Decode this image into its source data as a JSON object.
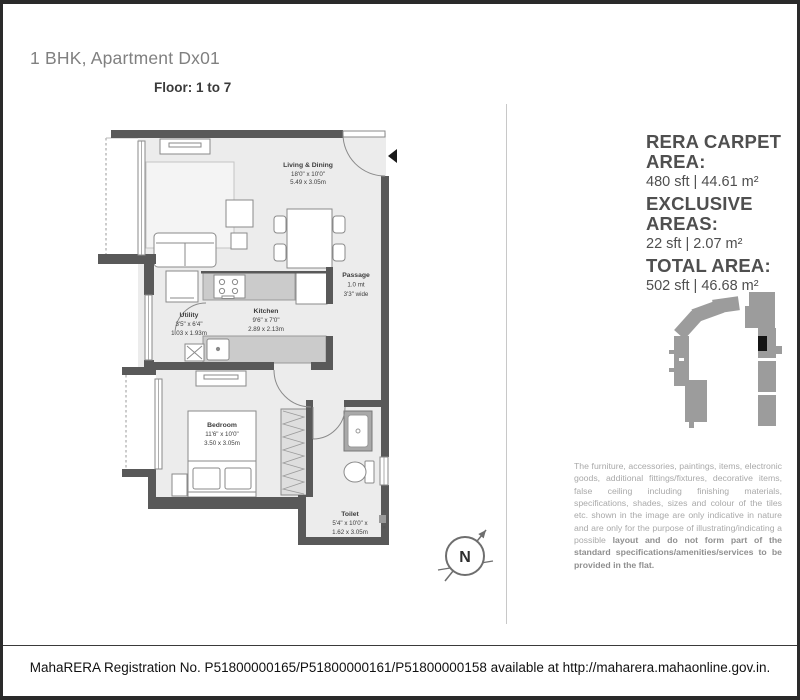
{
  "header": {
    "title": "1 BHK, Apartment Dx01",
    "floor_label": "Floor: 1 to 7"
  },
  "area_panel": {
    "items": [
      {
        "label": "RERA CARPET AREA:",
        "value": "480 sft | 44.61 m²"
      },
      {
        "label": "EXCLUSIVE AREAS:",
        "value": "22 sft | 2.07 m²"
      },
      {
        "label": "TOTAL AREA:",
        "value": "502 sft | 46.68 m²"
      }
    ]
  },
  "floor_plan": {
    "rooms": {
      "living": {
        "name": "Living & Dining",
        "dim_ft": "18'0\" x 10'0\"",
        "dim_m": "5.49 x 3.05m"
      },
      "passage": {
        "name": "Passage",
        "dim_ft": "1.0 mt",
        "dim_m": "3'3\" wide"
      },
      "kitchen": {
        "name": "Kitchen",
        "dim_ft": "9'6\" x 7'0\"",
        "dim_m": "2.89 x 2.13m"
      },
      "utility": {
        "name": "Utility",
        "dim_ft": "3'5\" x 6'4\"",
        "dim_m": "1.03 x 1.93m"
      },
      "bedroom": {
        "name": "Bedroom",
        "dim_ft": "11'6\" x 10'0\"",
        "dim_m": "3.50 x 3.05m"
      },
      "toilet": {
        "name": "Toilet",
        "dim_ft": "5'4\" x 10'0\" x",
        "dim_m": "1.62 x 3.05m"
      }
    }
  },
  "compass": {
    "label": "N"
  },
  "disclaimer": {
    "normal": "The furniture, accessories, paintings, items, electronic goods, additional fittings/fixtures, decorative items, false ceiling including finishing materials, specifications, shades, sizes and colour of the tiles etc. shown in the image are only indicative in nature and are only for the purpose of illustrating/indicating a possible ",
    "bold": "layout and do not form part of the standard specifications/amenities/services to be provided in the flat."
  },
  "footer": {
    "text": "MahaRERA Registration No. P51800000165/P51800000161/P51800000158 available at http://maharera.mahaonline.gov.in."
  },
  "colors": {
    "wall": "#595959",
    "floor": "#ececec",
    "counter": "#cbcbcb",
    "keyplan_gray": "#9c9c9c",
    "unit_black": "#141414",
    "title_gray": "#808080",
    "text_dark": "#4f4f4f"
  }
}
